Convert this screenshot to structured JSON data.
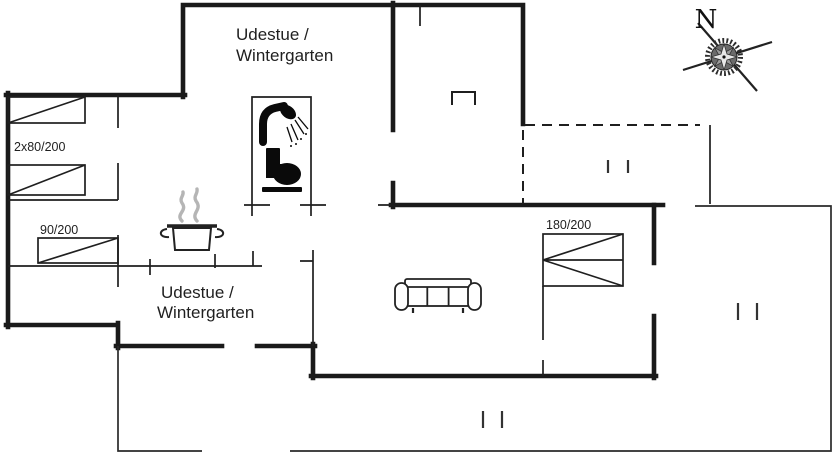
{
  "plan": {
    "rooms": {
      "wintergarden_top": {
        "line1": "Udestue /",
        "line2": "Wintergarten"
      },
      "wintergarden_bottom": {
        "line1": "Udestue /",
        "line2": "Wintergarten"
      }
    },
    "beds": {
      "twin": {
        "label": "2x80/200"
      },
      "single": {
        "label": "90/200"
      },
      "double": {
        "label": "180/200"
      }
    },
    "compass": {
      "north_label": "N"
    },
    "colors": {
      "ink": "#1a1a1a",
      "steam": "#b5b5b5",
      "background": "#ffffff"
    },
    "icons": {
      "shower": "shower-icon",
      "toilet": "toilet-icon",
      "cooking_pot": "cooking-pot-icon",
      "sofa": "sofa-icon",
      "compass_rose": "compass-rose-icon",
      "chimney": "chimney-icon",
      "window_marks": "window-tick-icon"
    }
  }
}
